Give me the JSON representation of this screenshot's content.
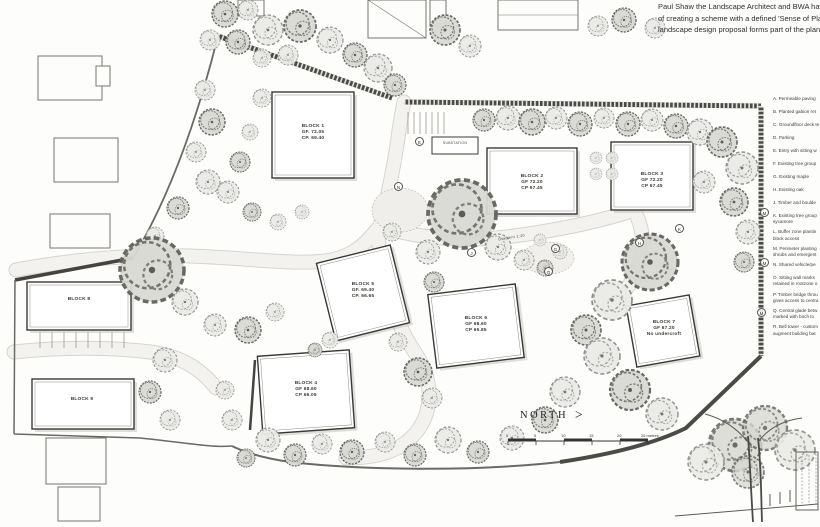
{
  "intro": {
    "line1": "Paul Shaw the Landscape Architect and BWA hav",
    "line2": "of creating a scheme with a defined 'Sense of Pla",
    "line3": "landscape design proposal forms part of the plan"
  },
  "legend": {
    "items": [
      {
        "l1": "A. Permeable paving"
      },
      {
        "l1": "B. Planted gabion ret"
      },
      {
        "l1": "C. Groundfloor deck te"
      },
      {
        "l1": "D. Parking"
      },
      {
        "l1": "E. Entry with sitting w"
      },
      {
        "l1": "F. Existing tree group"
      },
      {
        "l1": "G. Existing maple"
      },
      {
        "l1": "H. Existing oak"
      },
      {
        "l1": "J. Timber and boulde"
      },
      {
        "l1": "K. Existing tree group",
        "l2": "sycamore"
      },
      {
        "l1": "L. Buffer zone plantin",
        "l2": "block access"
      },
      {
        "l1": "M. Perimeter planting",
        "l2": "shrubs and emergent"
      },
      {
        "l1": "N. Shared vehicle/pe"
      },
      {
        "l1": "O. Sitting wall marks",
        "l2": "retained in rootzone o"
      },
      {
        "l1": "P. Timber bridge throu",
        "l2": "gives access to centra"
      },
      {
        "l1": "Q. Central glade betw",
        "l2": "marked with birch to"
      },
      {
        "l1": "R. Bell tower - custom",
        "l2": "augment building bat"
      }
    ]
  },
  "blocks": [
    {
      "name": "BLOCK 1",
      "gf": "GF. 72.05",
      "cp": "CP. 69.40"
    },
    {
      "name": "BLOCK 2",
      "gf": "GF 72.20",
      "cp": "CP 67.45"
    },
    {
      "name": "BLOCK 3",
      "gf": "GF 72.20",
      "cp": "CP 67.45"
    },
    {
      "name": "BLOCK 4",
      "gf": "GF 68.60",
      "cp": "CP 66.05"
    },
    {
      "name": "BLOCK 5",
      "gf": "GF. 69.40",
      "cp": "CP. 66.65"
    },
    {
      "name": "BLOCK 6",
      "gf": "GF 68.60",
      "cp": "CP 65.85"
    },
    {
      "name": "BLOCK 7",
      "gf": "GF 67.20",
      "cp": "No undercroft"
    },
    {
      "name": "BLOCK 8"
    },
    {
      "name": "BLOCK 9"
    }
  ],
  "plan": {
    "substation": "SUBSTATION",
    "gradient": "Gradient 1:20",
    "north": "NORTH",
    "north_arrow": ">"
  },
  "scalebar": {
    "t0": "0",
    "t1": "5",
    "t2": "10",
    "t3": "15",
    "t4": "20",
    "end": "25 metres"
  },
  "markers": {
    "letters": [
      "N",
      "M",
      "M",
      "M",
      "H",
      "G",
      "K",
      "Q",
      "J",
      "E"
    ]
  },
  "colors": {
    "paper": "#fdfdfc",
    "pencil": "#4b4a45",
    "tree_fill": "#ebebe8",
    "tree_dark": "#d9d9d4"
  }
}
